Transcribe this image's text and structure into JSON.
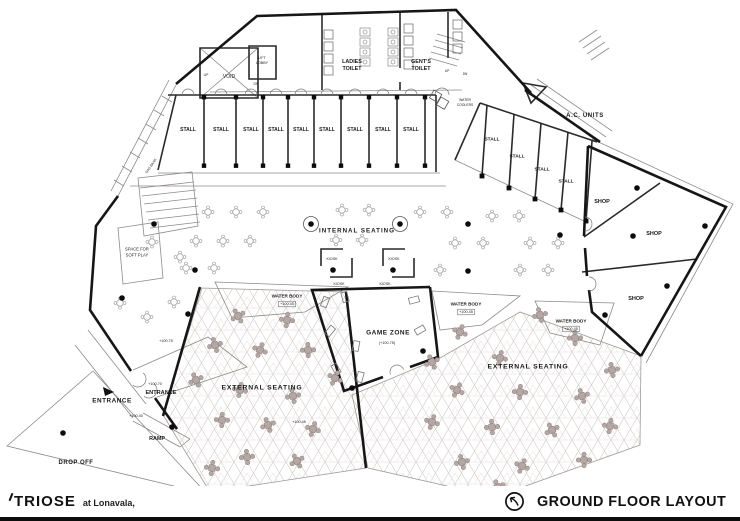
{
  "colors": {
    "wall": "#161616",
    "thin_line": "#8f8a88",
    "pattern_line": "#d3ccc9",
    "table_fill": "#b5a7a3",
    "table_stroke": "#8b807c"
  },
  "footer": {
    "logo": "TRIOSE",
    "location": "at Lonavala,",
    "title": "GROUND FLOOR LAYOUT",
    "icon": "north-arrow"
  },
  "plan": {
    "labels": [
      {
        "t": "VOID",
        "x": 229,
        "y": 77,
        "s": 5
      },
      {
        "t": "LIFT",
        "x": 262,
        "y": 58,
        "s": 3.6
      },
      {
        "t": "LOBBY",
        "x": 262,
        "y": 63,
        "s": 3.6
      },
      {
        "t": "LADIES",
        "x": 352,
        "y": 62,
        "s": 5.4,
        "b": 1
      },
      {
        "t": "TOILET",
        "x": 352,
        "y": 69,
        "s": 5.4,
        "b": 1
      },
      {
        "t": "GENT'S",
        "x": 421,
        "y": 62,
        "s": 5.4,
        "b": 1
      },
      {
        "t": "TOILET",
        "x": 421,
        "y": 69,
        "s": 5.4,
        "b": 1
      },
      {
        "t": "UP",
        "x": 206,
        "y": 75,
        "s": 3.4
      },
      {
        "t": "DN",
        "x": 256,
        "y": 84,
        "s": 3.4
      },
      {
        "t": "UP",
        "x": 447,
        "y": 71,
        "s": 3.2
      },
      {
        "t": "DN",
        "x": 465,
        "y": 74,
        "s": 3.2
      },
      {
        "t": "STALL",
        "x": 188,
        "y": 130,
        "s": 5,
        "b": 1
      },
      {
        "t": "STALL",
        "x": 221,
        "y": 130,
        "s": 5,
        "b": 1
      },
      {
        "t": "STALL",
        "x": 251,
        "y": 130,
        "s": 5,
        "b": 1
      },
      {
        "t": "STALL",
        "x": 276,
        "y": 130,
        "s": 5,
        "b": 1
      },
      {
        "t": "STALL",
        "x": 301,
        "y": 130,
        "s": 5,
        "b": 1
      },
      {
        "t": "STALL",
        "x": 327,
        "y": 130,
        "s": 5,
        "b": 1
      },
      {
        "t": "STALL",
        "x": 355,
        "y": 130,
        "s": 5,
        "b": 1
      },
      {
        "t": "STALL",
        "x": 383,
        "y": 130,
        "s": 5,
        "b": 1
      },
      {
        "t": "STALL",
        "x": 411,
        "y": 130,
        "s": 5,
        "b": 1
      },
      {
        "t": "WATER",
        "x": 465,
        "y": 100,
        "s": 3.4
      },
      {
        "t": "COOLERS",
        "x": 465,
        "y": 105,
        "s": 3.4
      },
      {
        "t": "A.C. UNITS",
        "x": 585,
        "y": 116,
        "s": 6,
        "b": 1,
        "ls": 0.6
      },
      {
        "t": "STALL",
        "x": 492,
        "y": 140,
        "s": 4.8,
        "b": 1
      },
      {
        "t": "STALL",
        "x": 517,
        "y": 157,
        "s": 4.8,
        "b": 1
      },
      {
        "t": "STALL",
        "x": 542,
        "y": 170,
        "s": 4.8,
        "b": 1
      },
      {
        "t": "STALL",
        "x": 566,
        "y": 182,
        "s": 4.8,
        "b": 1
      },
      {
        "t": "SHOP",
        "x": 602,
        "y": 202,
        "s": 5.5,
        "b": 1
      },
      {
        "t": "SHOP",
        "x": 654,
        "y": 234,
        "s": 5.5,
        "b": 1
      },
      {
        "t": "SHOP",
        "x": 636,
        "y": 299,
        "s": 5.5,
        "b": 1
      },
      {
        "t": "INTERNAL SEATING",
        "x": 357,
        "y": 231,
        "s": 6.2,
        "b": 1,
        "ls": 1
      },
      {
        "t": "KIOSK",
        "x": 332,
        "y": 259,
        "s": 3.6
      },
      {
        "t": "KIOSK",
        "x": 339,
        "y": 284,
        "s": 3.6
      },
      {
        "t": "KIOSK",
        "x": 394,
        "y": 259,
        "s": 3.6
      },
      {
        "t": "KIOSK",
        "x": 385,
        "y": 284,
        "s": 3.6
      },
      {
        "t": "WATER BODY",
        "x": 287,
        "y": 296,
        "s": 4.6,
        "b": 1
      },
      {
        "t": "+100.45",
        "x": 287,
        "y": 304,
        "s": 3.8,
        "box": 1
      },
      {
        "t": "WATER BODY",
        "x": 466,
        "y": 304,
        "s": 4.6,
        "b": 1
      },
      {
        "t": "+100.45",
        "x": 466,
        "y": 312,
        "s": 3.8,
        "box": 1
      },
      {
        "t": "WATER BODY",
        "x": 571,
        "y": 321,
        "s": 4.6,
        "b": 1
      },
      {
        "t": "+100.45",
        "x": 571,
        "y": 329,
        "s": 3.8,
        "box": 1
      },
      {
        "t": "GAME ZONE",
        "x": 388,
        "y": 333,
        "s": 6.5,
        "b": 1,
        "ls": 0.5
      },
      {
        "t": "(+100.75)",
        "x": 387,
        "y": 343,
        "s": 3.8
      },
      {
        "t": "EXTERNAL SEATING",
        "x": 262,
        "y": 388,
        "s": 6.8,
        "b": 1,
        "ls": 0.8
      },
      {
        "t": "+100.45",
        "x": 299,
        "y": 422,
        "s": 3.8
      },
      {
        "t": "EXTERNAL SEATING",
        "x": 528,
        "y": 367,
        "s": 6.8,
        "b": 1,
        "ls": 0.8
      },
      {
        "t": "SPACE FOR",
        "x": 137,
        "y": 249,
        "s": 4.2
      },
      {
        "t": "SOFT PLAY",
        "x": 137,
        "y": 255,
        "s": 4.2
      },
      {
        "t": "GAS BANK",
        "x": 151,
        "y": 166,
        "s": 3.4,
        "r": -55
      },
      {
        "t": "+100.75",
        "x": 166,
        "y": 341,
        "s": 3.8
      },
      {
        "t": "ENTRANCE",
        "x": 112,
        "y": 401,
        "s": 6.4,
        "b": 1,
        "ls": 0.5
      },
      {
        "t": "ENTRANCE",
        "x": 161,
        "y": 393,
        "s": 5.6,
        "b": 1
      },
      {
        "t": "+100.70",
        "x": 155,
        "y": 384,
        "s": 3.8
      },
      {
        "t": "+100.40",
        "x": 136,
        "y": 416,
        "s": 3.8
      },
      {
        "t": "RAMP",
        "x": 157,
        "y": 439,
        "s": 5.4,
        "b": 1
      },
      {
        "t": "DROP OFF",
        "x": 76,
        "y": 463,
        "s": 6,
        "b": 1,
        "ls": 0.5
      }
    ]
  }
}
